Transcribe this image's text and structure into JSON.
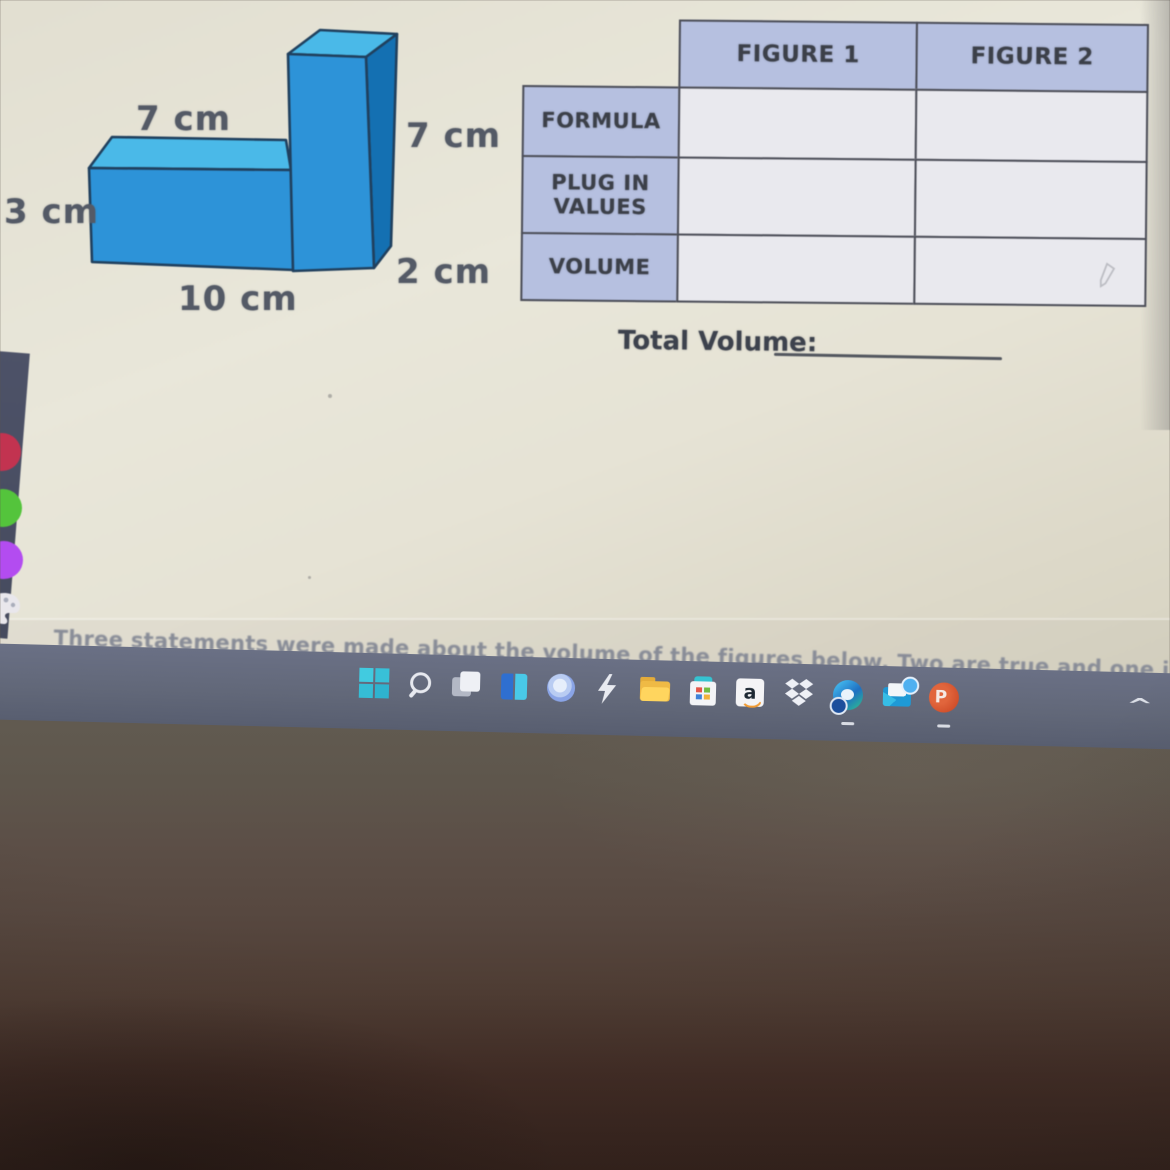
{
  "worksheet": {
    "figure_labels": {
      "horizontal_top": "7 cm",
      "horizontal_left": "3 cm",
      "horizontal_bottom": "10 cm",
      "vertical_right": "7 cm",
      "vertical_depth": "2 cm"
    },
    "figure_colors": {
      "top_face": "#4ab9e8",
      "front_face": "#2d93d8",
      "side_face": "#1470b2",
      "outline": "#20405e"
    },
    "table": {
      "column_headers": [
        "FIGURE 1",
        "FIGURE 2"
      ],
      "row_headers": [
        "FORMULA",
        "PLUG IN VALUES",
        "VOLUME"
      ],
      "cells": [
        [
          "",
          ""
        ],
        [
          "",
          ""
        ],
        [
          "",
          ""
        ]
      ],
      "header_bg": "#b6c0e0",
      "cell_bg": "#e9e9ee",
      "border_color": "#4b4d57"
    },
    "total_volume_label": "Total Volume:",
    "bottom_text": "Three statements were made about the volume of the figures below. Two are true and one is"
  },
  "taskbar": {
    "background": "#636a7f",
    "icons": [
      "start",
      "search",
      "task-view",
      "blue-panels-app",
      "round-blue-app",
      "lightning-app",
      "file-explorer",
      "microsoft-store",
      "amazon",
      "dropbox",
      "edge-browser",
      "mail",
      "powerpoint"
    ],
    "amazon_glyph": "a",
    "powerpoint_glyph": "P",
    "tray_chevron_glyph": "^"
  },
  "sidebar_tools": {
    "colors": [
      "#c23350",
      "#54c43c",
      "#b34cf0"
    ],
    "palette_icon": "palette"
  }
}
